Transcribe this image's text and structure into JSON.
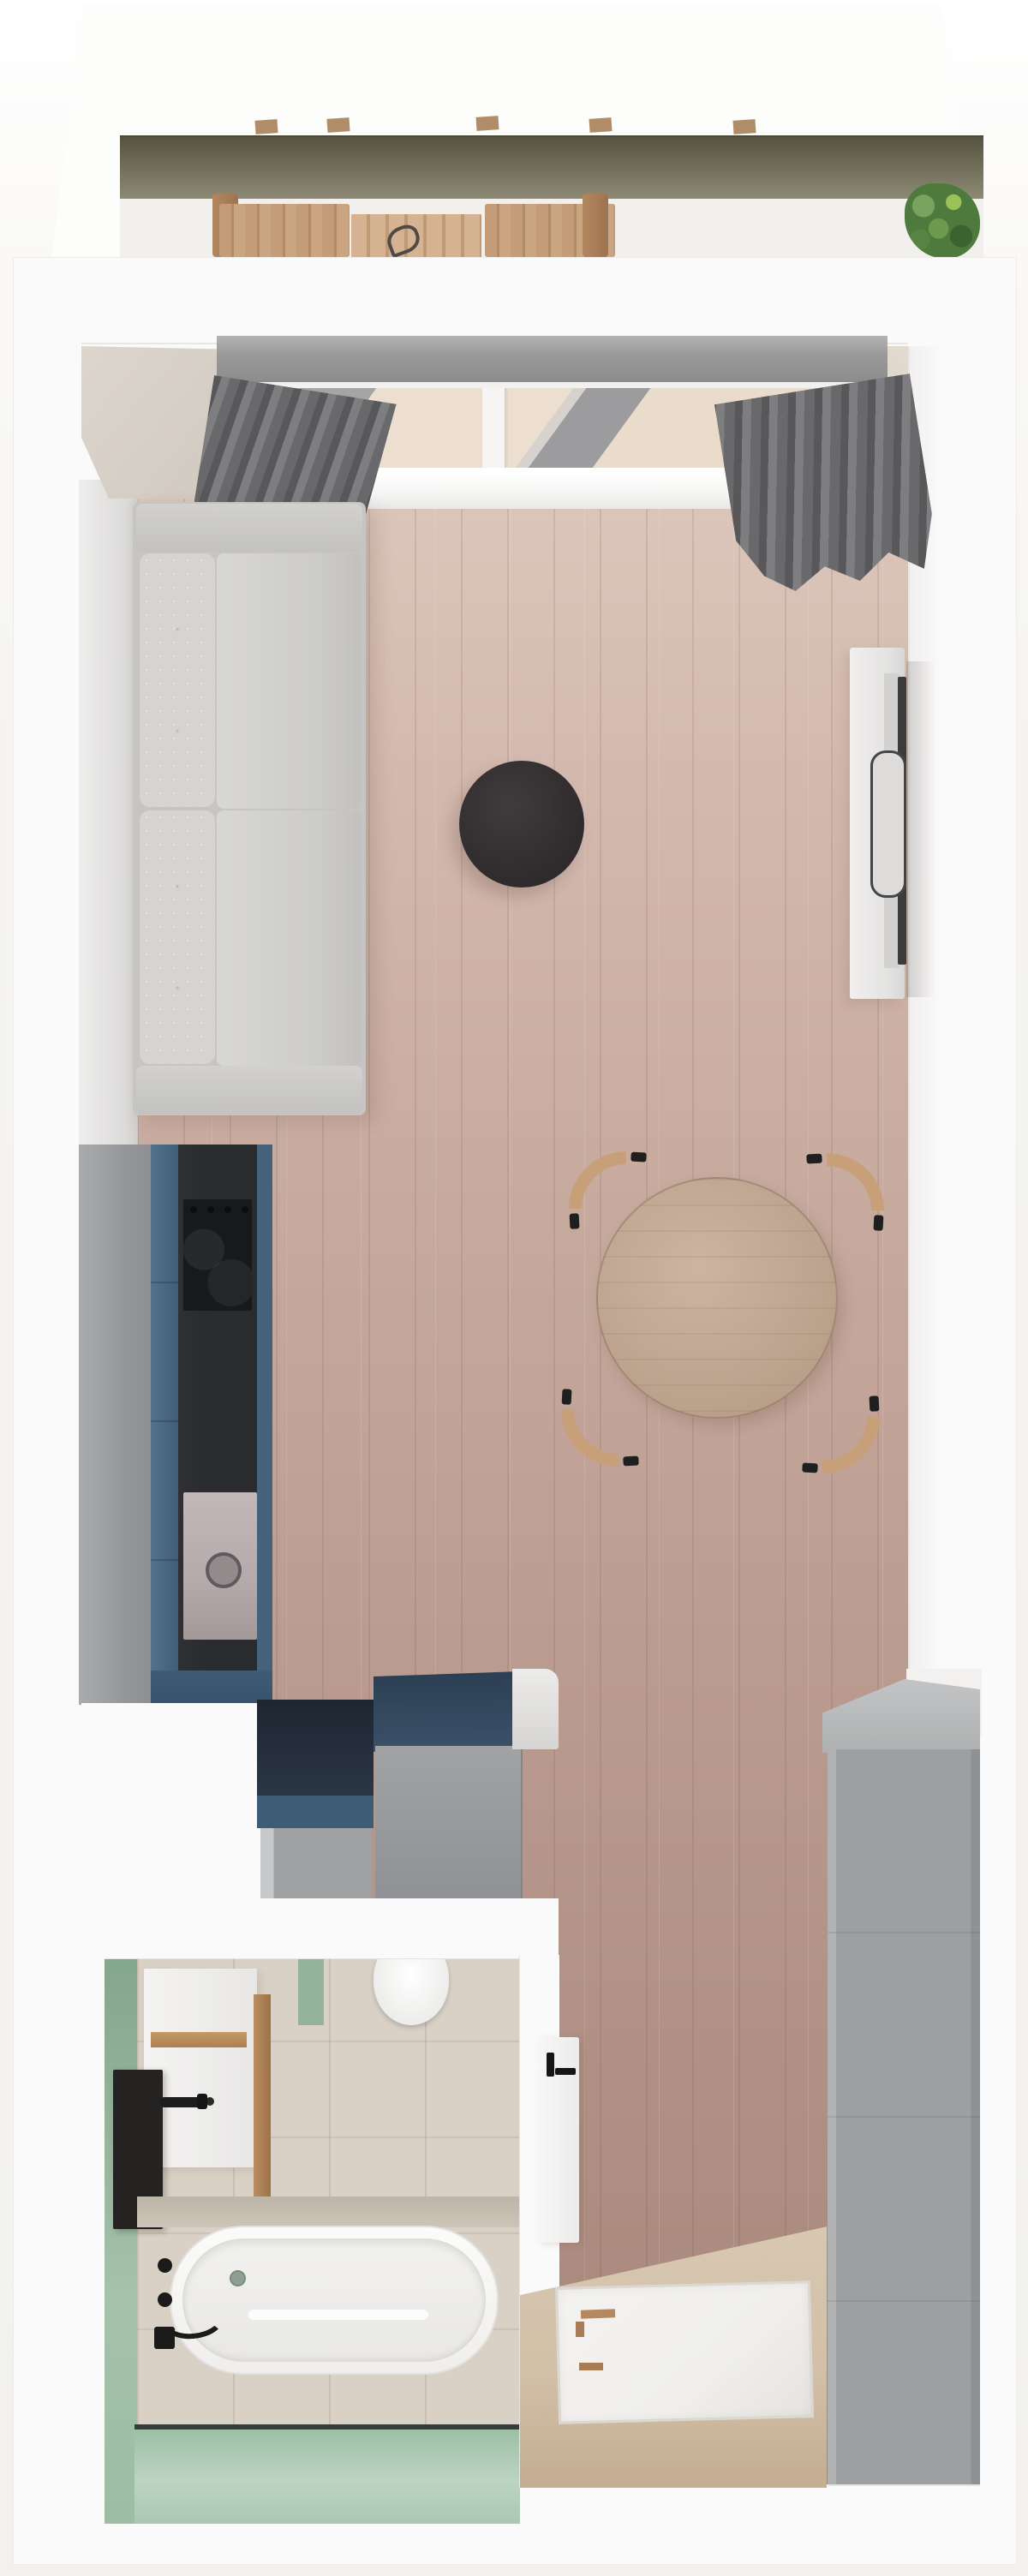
{
  "meta": {
    "title": "Studio apartment floor plan — photorealistic top-down 3D render",
    "type": "3d-floor-plan-render"
  },
  "colors": {
    "page_bg": "#f5f4f2",
    "wall": "#fbfafa",
    "wall_edge": "#e9e7e5",
    "wall_beige": "#d8d1c7",
    "rail_dark": "#565441",
    "rail_light": "#8e8c76",
    "deck": "#f2f0ed",
    "out_wood": "#c49c77",
    "out_wood_dark": "#a2784f",
    "plant": "#4e7a3d",
    "plant_light": "#79a45f",
    "pelmet": "#9c9c9c",
    "curtain_a": "#58585a",
    "curtain_b": "#7e7e80",
    "curtain_c": "#69696b",
    "glass": "#d8d2ce",
    "frame_white": "#f6f5f4",
    "floor_hi": "#dcc6bb",
    "floor_lo": "#a78679",
    "plank": "rgba(96,64,50,0.12)",
    "sofa_frame": "#c6c5c2",
    "sofa_cushion": "#d5d4d1",
    "side_table": "#343031",
    "console": "#ebeae9",
    "tv": "#3b3b3d",
    "table_wood": "#c2a994",
    "chair_wood": "#c79f78",
    "black": "#1f1f1f",
    "kit_gray": "#9b9d9f",
    "kit_blue": "#46617a",
    "kit_blue_deep": "#37526c",
    "counter": "#292b2f",
    "hob": "#17191d",
    "sink": "#b4aaab",
    "navy": "#2e4156",
    "navy_deep": "#1e2631",
    "cab_gray": "#9fa1a3",
    "bath_floor": "#dad1c6",
    "green": "#9dbda4",
    "green_light": "#bcd4c2",
    "green_deep": "#84a68c",
    "tub": "#f8f8f7",
    "fixture": "#1d1d1d",
    "wood_accent": "#b98c62",
    "shower_floor": "#d2c0a8",
    "tray": "#f0efec",
    "ward_gray": "#9ca0a2",
    "ward_top": "#c3c4c5"
  },
  "rooms": {
    "balcony": "Balcony",
    "living": "Living room",
    "kitchen": "Kitchen",
    "hall": "Hallway storage",
    "bathroom": "Bathroom",
    "shower": "Shower area",
    "wardrobe": "Wardrobe"
  },
  "items": {
    "railing": "Balcony glass railing",
    "deck": "Balcony deck",
    "out_table": "Outdoor dining table",
    "out_bench": "Outdoor bench",
    "plant": "Potted plant",
    "pelmet": "Curtain rail box",
    "curtain": "Curtain",
    "window": "Balcony window",
    "sill": "Window sill",
    "wood_floor": "Wood plank floor",
    "sofa": "Two-seat sofa",
    "side_table": "Round black side table",
    "tv_console": "TV sideboard",
    "tv": "Wall-mounted TV",
    "dining_table": "Round dining table",
    "chair": "Dining chair",
    "tall_cabinet": "Tall kitchen cabinet",
    "kitchen_unit": "Blue kitchen unit",
    "worktop": "Dark kitchen worktop",
    "hob": "Cooktop",
    "sink": "Kitchen sink",
    "open_shelf": "Open shelf unit",
    "storage_cabinet": "Storage cabinet",
    "toilet": "Toilet",
    "vanity": "Washbasin vanity",
    "wall_shelf": "Black wall shelf",
    "basin_faucet": "Basin mixer",
    "bathtub": "Bathtub",
    "bath_faucet": "Bath mixer fittings",
    "tile_floor": "Bathroom tile floor",
    "green_wall": "Green accent wall",
    "partition": "Glass partition",
    "shower_tray": "Shower tray",
    "shower_door": "Shower door",
    "shower_floor_label": "Shower tile floor",
    "wardrobe_unit": "Built-in wardrobe"
  }
}
